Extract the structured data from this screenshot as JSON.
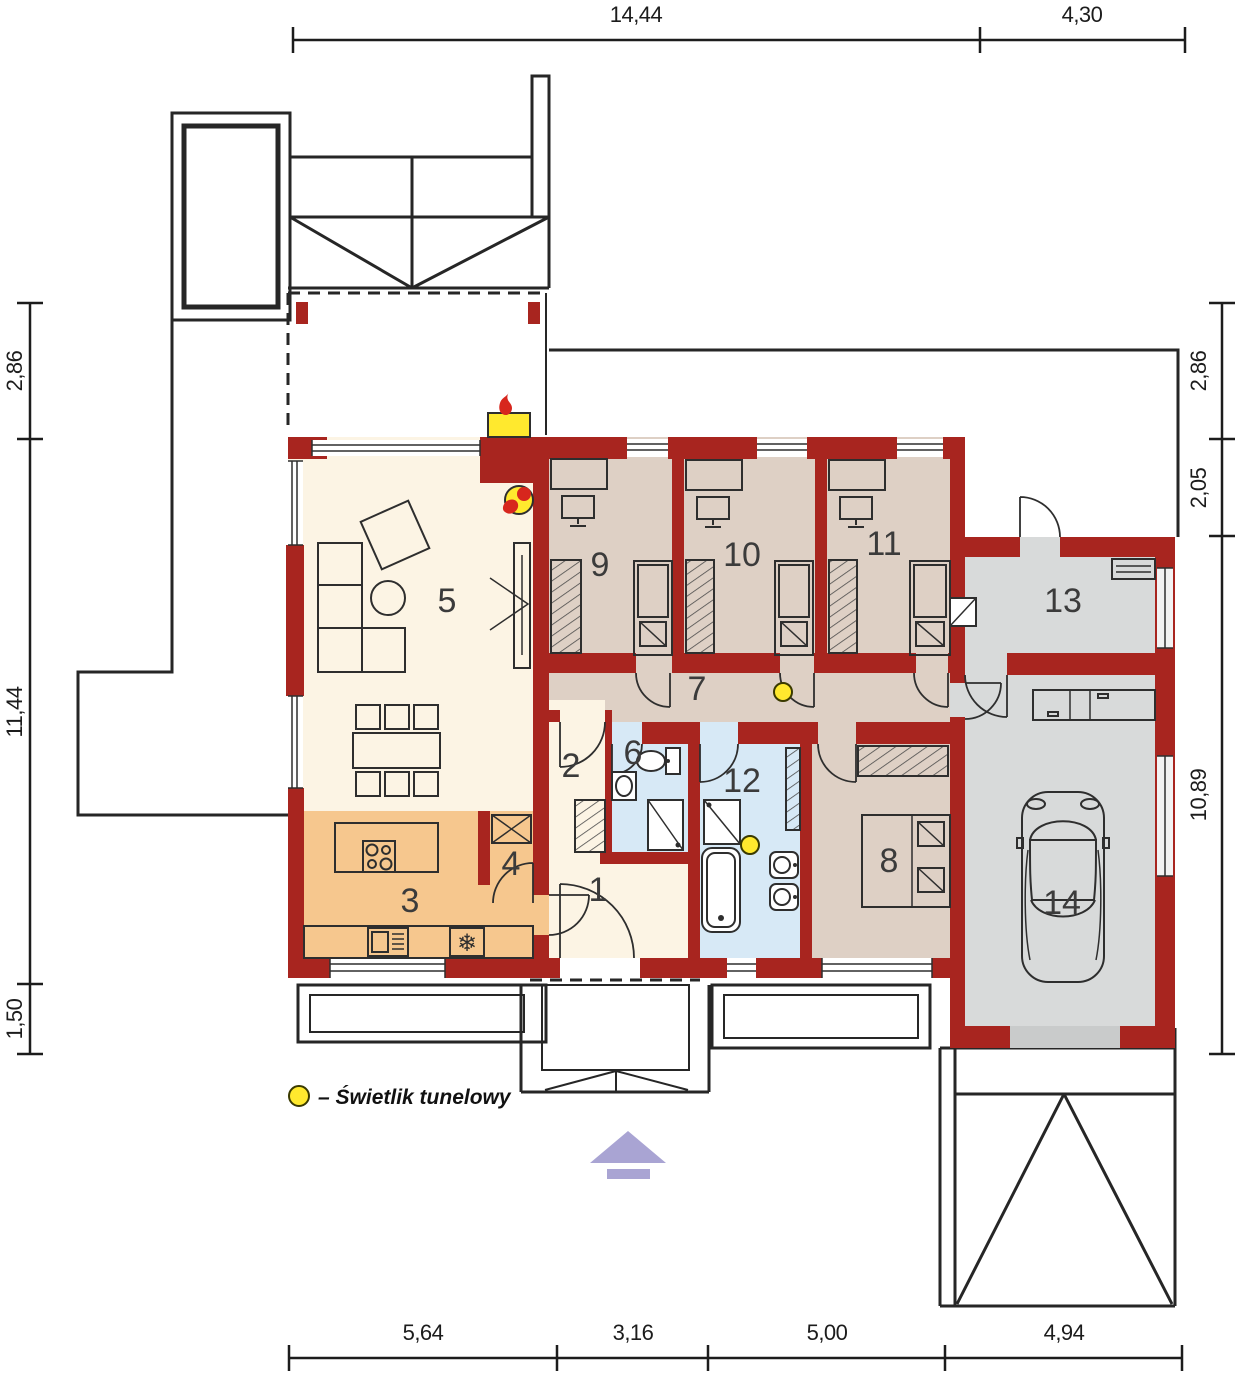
{
  "palette": {
    "wall": "#a8251f",
    "outline": "#262626",
    "furniture_line": "#2e2e2e",
    "floor_living": "#fcf4e4",
    "floor_kitchen": "#f6c78e",
    "floor_bedroom": "#ded0c5",
    "floor_bath": "#d7e9f6",
    "floor_garage": "#d8dada",
    "garage_door": "#c9cbcb",
    "skylight_yellow": "#ffe92e",
    "flame_red": "#d7261d",
    "arrow_lavender": "#a9a4d3"
  },
  "dimensions": {
    "top": [
      "14,44",
      "4,30"
    ],
    "bottom": [
      "5,64",
      "3,16",
      "5,00",
      "4,94"
    ],
    "left": [
      "2,86",
      "11,44",
      "1,50"
    ],
    "right": [
      "2,86",
      "2,05",
      "10,89"
    ]
  },
  "rooms": [
    {
      "number": "1"
    },
    {
      "number": "2"
    },
    {
      "number": "3"
    },
    {
      "number": "4"
    },
    {
      "number": "5"
    },
    {
      "number": "6"
    },
    {
      "number": "7"
    },
    {
      "number": "8"
    },
    {
      "number": "9"
    },
    {
      "number": "10"
    },
    {
      "number": "11"
    },
    {
      "number": "12"
    },
    {
      "number": "13"
    },
    {
      "number": "14"
    }
  ],
  "legend": {
    "symbol": "tunnel-skylight",
    "label": "– Świetlik tunelowy"
  },
  "icons": {
    "snowflake": "❄"
  }
}
